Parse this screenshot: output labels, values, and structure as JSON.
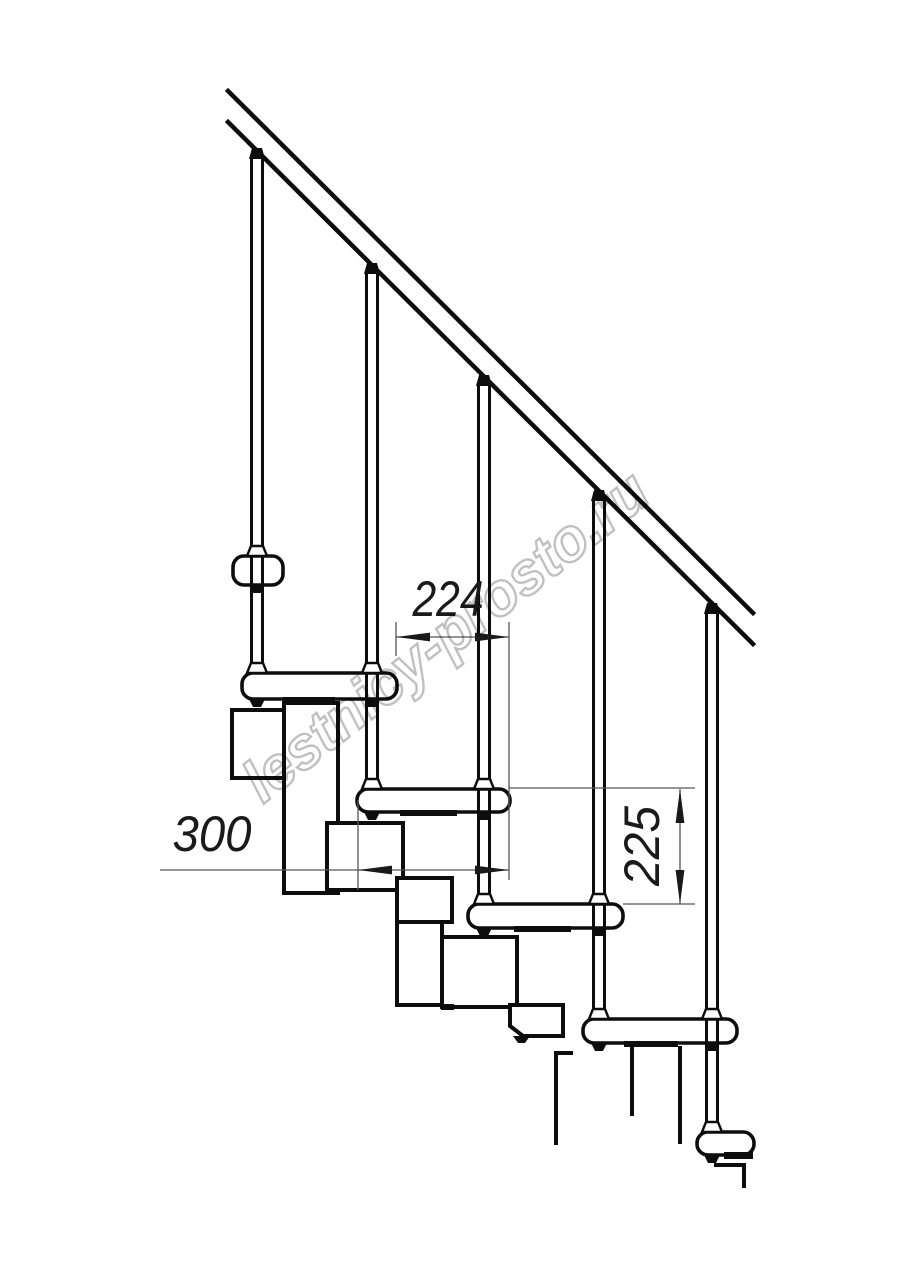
{
  "canvas": {
    "width": 914,
    "height": 1280,
    "background": "#ffffff"
  },
  "colors": {
    "line": "#0d0d0d",
    "thin_line": "#565656",
    "dimension_ink": "#1a1a1a",
    "watermark": "#c0c0c0",
    "tread_fill": "#ffffff"
  },
  "watermark": {
    "text": "lestnicy-prosto.ru"
  },
  "dimension_labels": {
    "run": "224",
    "tread_depth": "300",
    "rise": "225"
  },
  "figure": {
    "treads_count": 6,
    "balusters_count": 5,
    "handrail": true
  }
}
